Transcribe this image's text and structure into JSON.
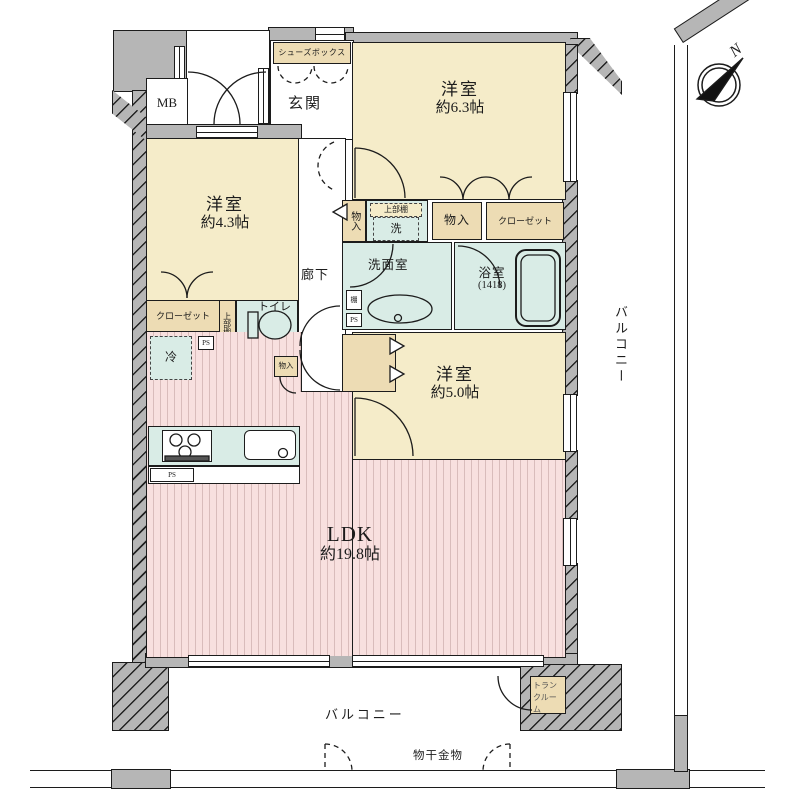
{
  "title": "マンション間取り図",
  "labels": {
    "mb": "MB",
    "shoes_box": "シューズボックス",
    "genkan": "玄関",
    "counter": "カウンター",
    "western1_name": "洋室",
    "western1_size": "約6.3帖",
    "western2_name": "洋室",
    "western2_size": "約4.3帖",
    "western3_name": "洋室",
    "western3_size": "約5.0帖",
    "ldk_name": "LDK",
    "ldk_size": "約19.8帖",
    "corridor": "廊下",
    "monoire_vertical": "物入",
    "monoire_top": "物入",
    "monoire_small": "物入",
    "upper_shelf_wash": "上部棚",
    "upper_shelf_toilet": "上部棚",
    "washer": "洗",
    "closet_top": "クローゼット",
    "closet_left": "クローゼット",
    "washroom": "洗面室",
    "bathroom_name": "浴室",
    "bathroom_size": "(1418)",
    "shelf": "棚",
    "toilet": "トイレ",
    "fridge": "冷",
    "ps1": "PS",
    "ps2": "PS",
    "ps3": "PS",
    "balcony_right": "バルコニー",
    "balcony_bottom": "バルコニー",
    "laundry_hardware": "物干金物",
    "trunk_room": "トランクルーム",
    "compass_n": "N"
  },
  "colors": {
    "wall_gray": "#b6b6b6",
    "room_cream": "#f5ecc9",
    "closet_tan": "#eddcb4",
    "wet_teal": "#d9ece6",
    "ldk_pink": "#f8e0df",
    "line": "#1c1c1c"
  }
}
